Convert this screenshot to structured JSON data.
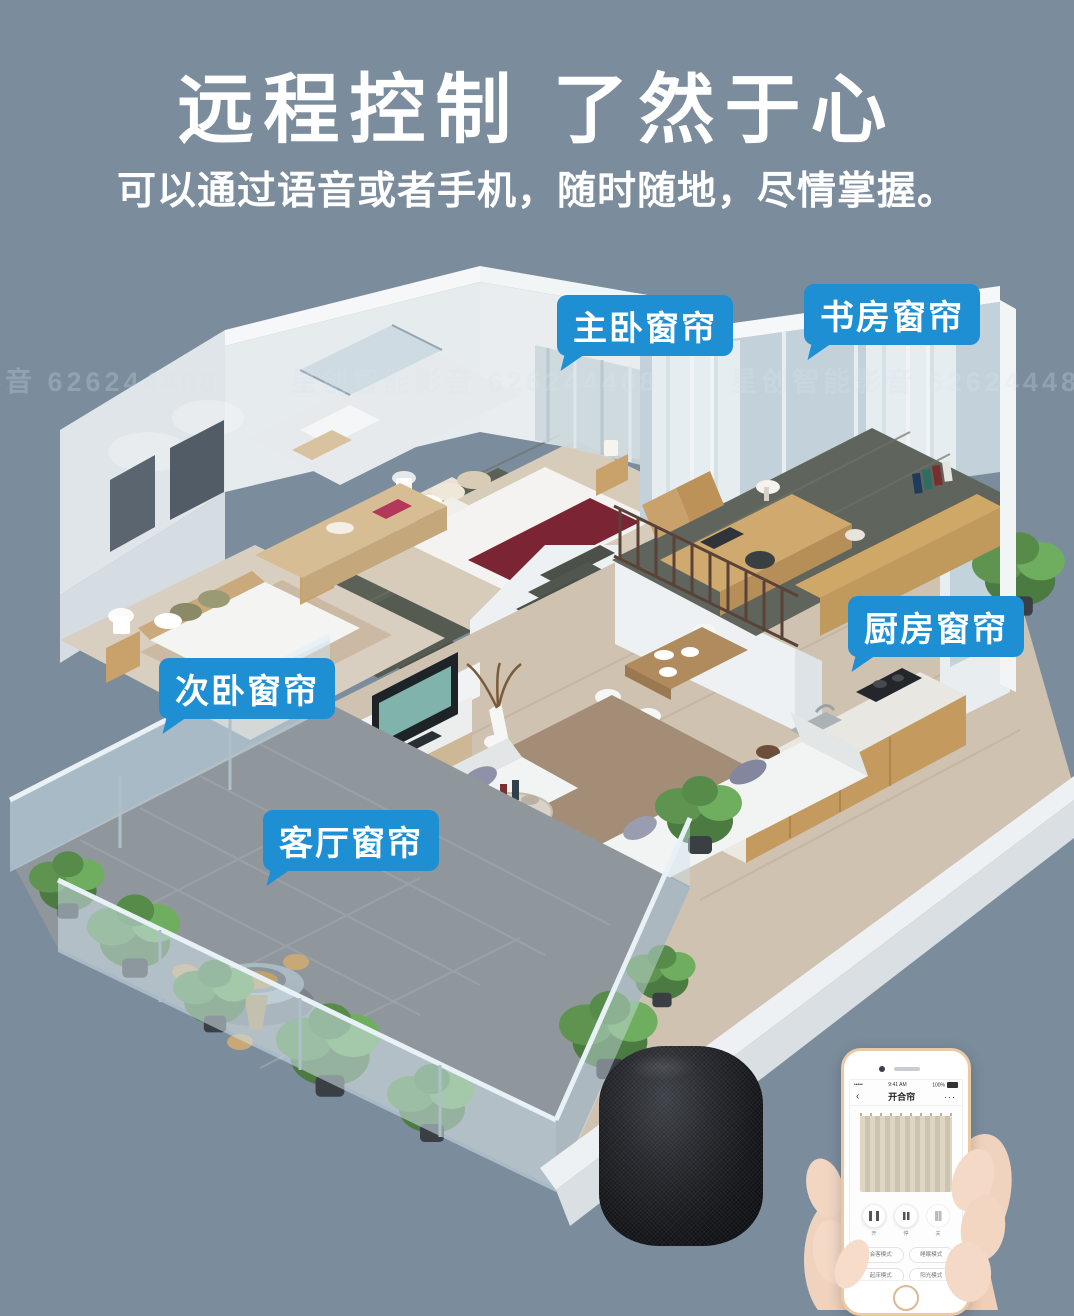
{
  "page": {
    "background": "#7b8c9d",
    "accent_blue": "#1f8fd4"
  },
  "header": {
    "title": "远程控制 了然于心",
    "subtitle": "可以通过语音或者手机，随时随地，尽情掌握。"
  },
  "watermark": {
    "text": "星创智能影音 626244488"
  },
  "callouts": [
    {
      "id": "master-bedroom",
      "label": "主卧窗帘"
    },
    {
      "id": "study",
      "label": "书房窗帘"
    },
    {
      "id": "kitchen",
      "label": "厨房窗帘"
    },
    {
      "id": "second-bedroom",
      "label": "次卧窗帘"
    },
    {
      "id": "living-room",
      "label": "客厅窗帘"
    }
  ],
  "devices": {
    "speaker": "smart-speaker",
    "phone": {
      "status": {
        "signal": "•••••",
        "time": "9:41 AM",
        "battery": "100%"
      },
      "nav": {
        "back": "‹",
        "title": "开合帘",
        "menu": "···"
      },
      "controls": [
        {
          "id": "open",
          "label": "开"
        },
        {
          "id": "pause",
          "label": "停"
        },
        {
          "id": "close",
          "label": "关"
        }
      ],
      "modes": [
        "会客模式",
        "睡眠模式",
        "起床模式",
        "阳光模式"
      ]
    }
  }
}
